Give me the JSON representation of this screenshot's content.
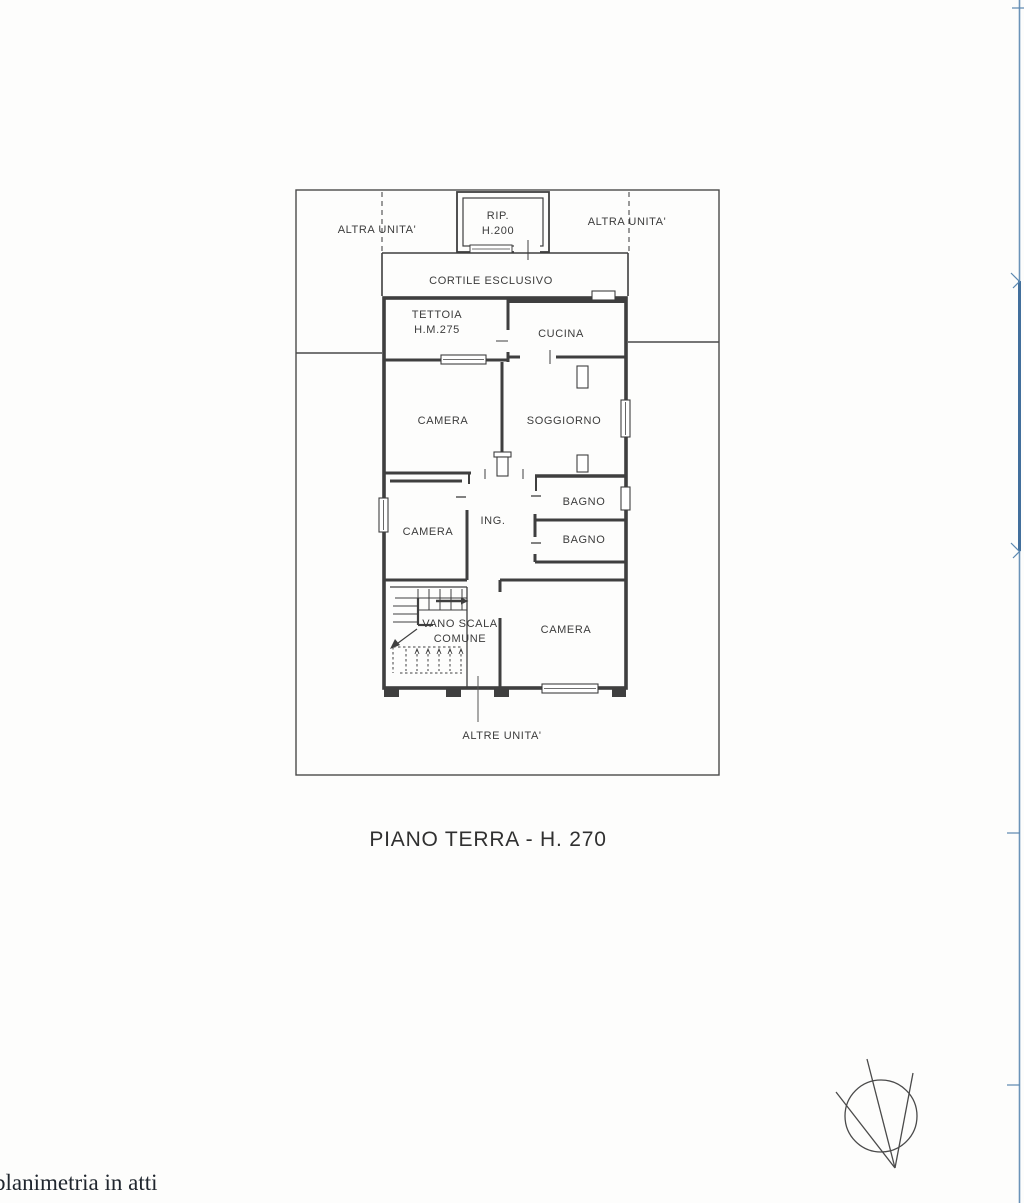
{
  "page": {
    "kind": "scanned floor plan",
    "background": "#fdfdfc"
  },
  "colors": {
    "ink": "#3f3f3f",
    "parcel_line": "#4a4a4a",
    "scan_edge_blue": "#6b93b8",
    "scan_edge_blue_dark": "#426f9c",
    "footer_ink": "#20262e"
  },
  "plan": {
    "labels": {
      "altra_unita_left": "ALTRA UNITA'",
      "altra_unita_right": "ALTRA UNITA'",
      "rip_line1": "RIP.",
      "rip_line2": "H.200",
      "cortile": "CORTILE ESCLUSIVO",
      "tettoia_line1": "TETTOIA",
      "tettoia_line2": "H.M.275",
      "cucina": "CUCINA",
      "camera_top": "CAMERA",
      "soggiorno": "SOGGIORNO",
      "bagno_top": "BAGNO",
      "ing": "ING.",
      "camera_mid": "CAMERA",
      "bagno_bottom": "BAGNO",
      "vano_scala_line1": "VANO SCALA",
      "vano_scala_line2": "COMUNE",
      "camera_bottom": "CAMERA",
      "altre_unita": "ALTRE UNITA'"
    },
    "title": "PIANO TERRA - H. 270"
  },
  "footer": {
    "note": "planimetria in atti"
  }
}
